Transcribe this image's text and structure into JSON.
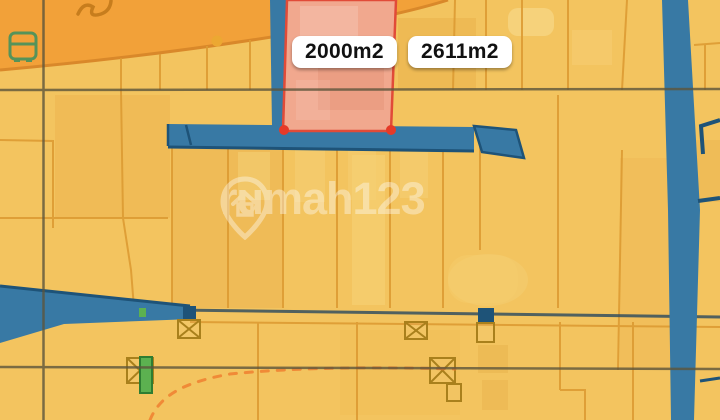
{
  "map": {
    "watermark_text": "rumah123",
    "labels": [
      {
        "text": "2000m2"
      },
      {
        "text": "2611m2"
      }
    ],
    "icons": [
      "bus-transit-icon",
      "rumah123-pin-logo",
      "crossing-marker-icon",
      "green-post-marker",
      "orange-poi-dot"
    ],
    "colors": {
      "base_yellow": "#f3c45f",
      "arterial_orange": "#f2a139",
      "parcel_line_orange": "#dd9b33",
      "road_blue": "#3879a4",
      "road_edge_navy": "#1e5378",
      "highlight_fill_pink": "#f1a88e",
      "highlight_border_red": "#e14b38",
      "vertex_dot_red": "#e53a28",
      "label_bg": "#ffffff",
      "label_text": "#111111",
      "marker_green": "#5cb150",
      "dashed_path_orange": "#ee8030",
      "frame_line": "#5d553c"
    }
  }
}
